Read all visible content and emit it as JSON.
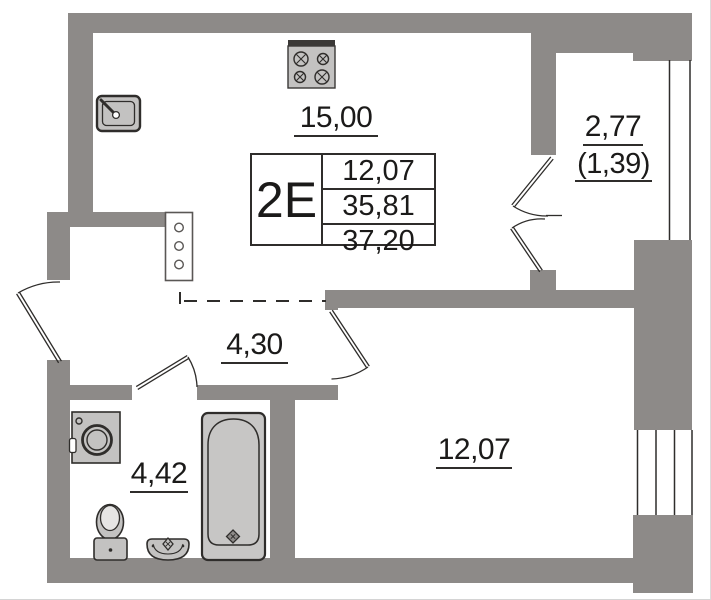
{
  "colors": {
    "wall": "#8d8a88",
    "line": "#2f2d2b",
    "fixture": "#c3c2c1",
    "fixture2": "#c7c6c5",
    "text": "#1b1a19",
    "background": "#ffffff"
  },
  "plan": {
    "info_table": {
      "type": "2Е",
      "values": [
        "12,07",
        "35,81",
        "37,20"
      ]
    },
    "labels": {
      "kitchen_living": "15,00",
      "hallway": "4,30",
      "bathroom": "4,42",
      "bedroom": "12,07",
      "balcony_total": "2,77",
      "balcony_reduced": "(1,39)"
    },
    "icons": {
      "stove": "stove-icon",
      "kitchen_sink": "kitchen-sink-icon",
      "washing_machine": "washing-machine-icon",
      "toilet": "toilet-icon",
      "washbasin": "washbasin-icon",
      "bathtub": "bathtub-icon",
      "riser_panel": "riser-panel-icon"
    }
  }
}
